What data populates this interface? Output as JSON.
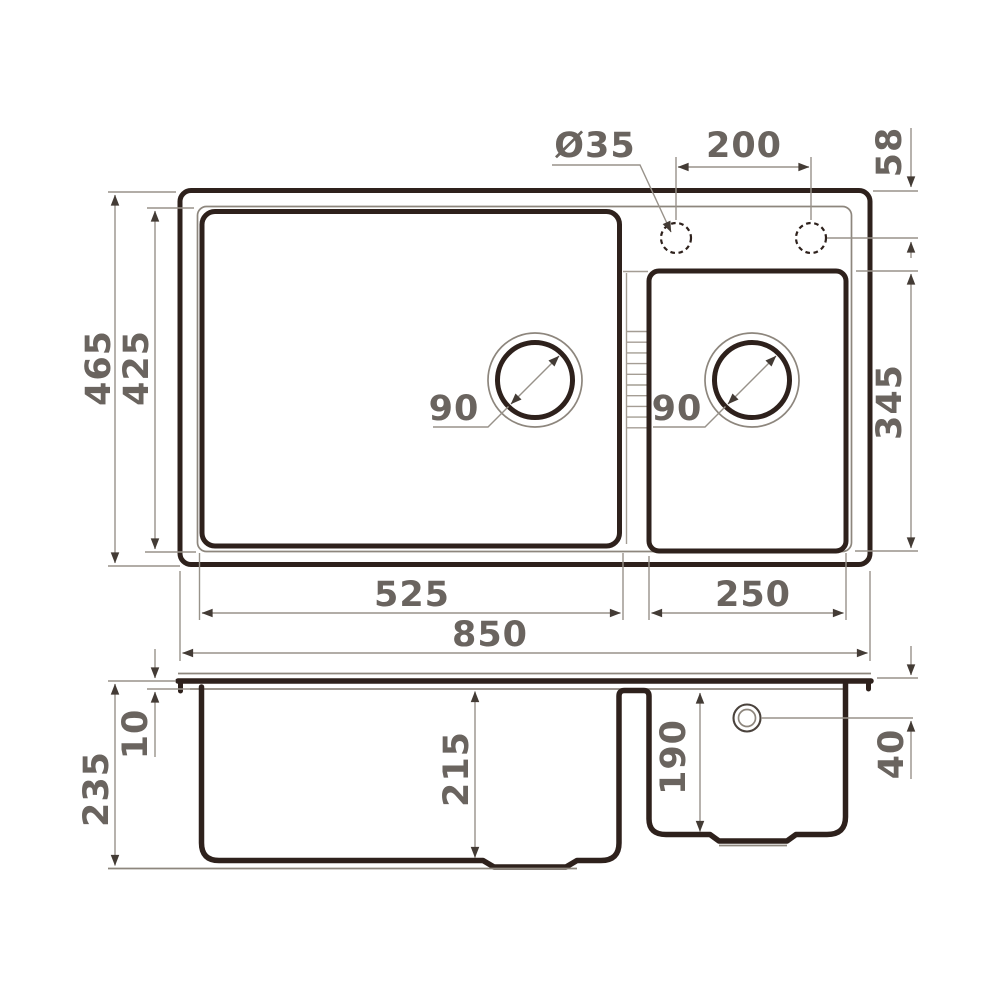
{
  "colors": {
    "outline": "#2e211c",
    "dimension_line": "#98928a",
    "label_text": "#6a645f",
    "background": "#ffffff"
  },
  "top_view": {
    "overall_width": "850",
    "overall_depth": "465",
    "inner_rim_depth": "425",
    "main_bowl_width": "525",
    "second_bowl_width": "250",
    "second_bowl_depth": "345",
    "faucet_hole_diameter": "Ø35",
    "faucet_hole_spacing": "200",
    "faucet_hole_offset": "58",
    "main_drain_diameter": "90",
    "second_drain_diameter": "90"
  },
  "side_view": {
    "overall_height": "235",
    "rim_thickness": "10",
    "main_bowl_depth": "215",
    "second_bowl_depth": "190",
    "overflow_offset": "40"
  }
}
